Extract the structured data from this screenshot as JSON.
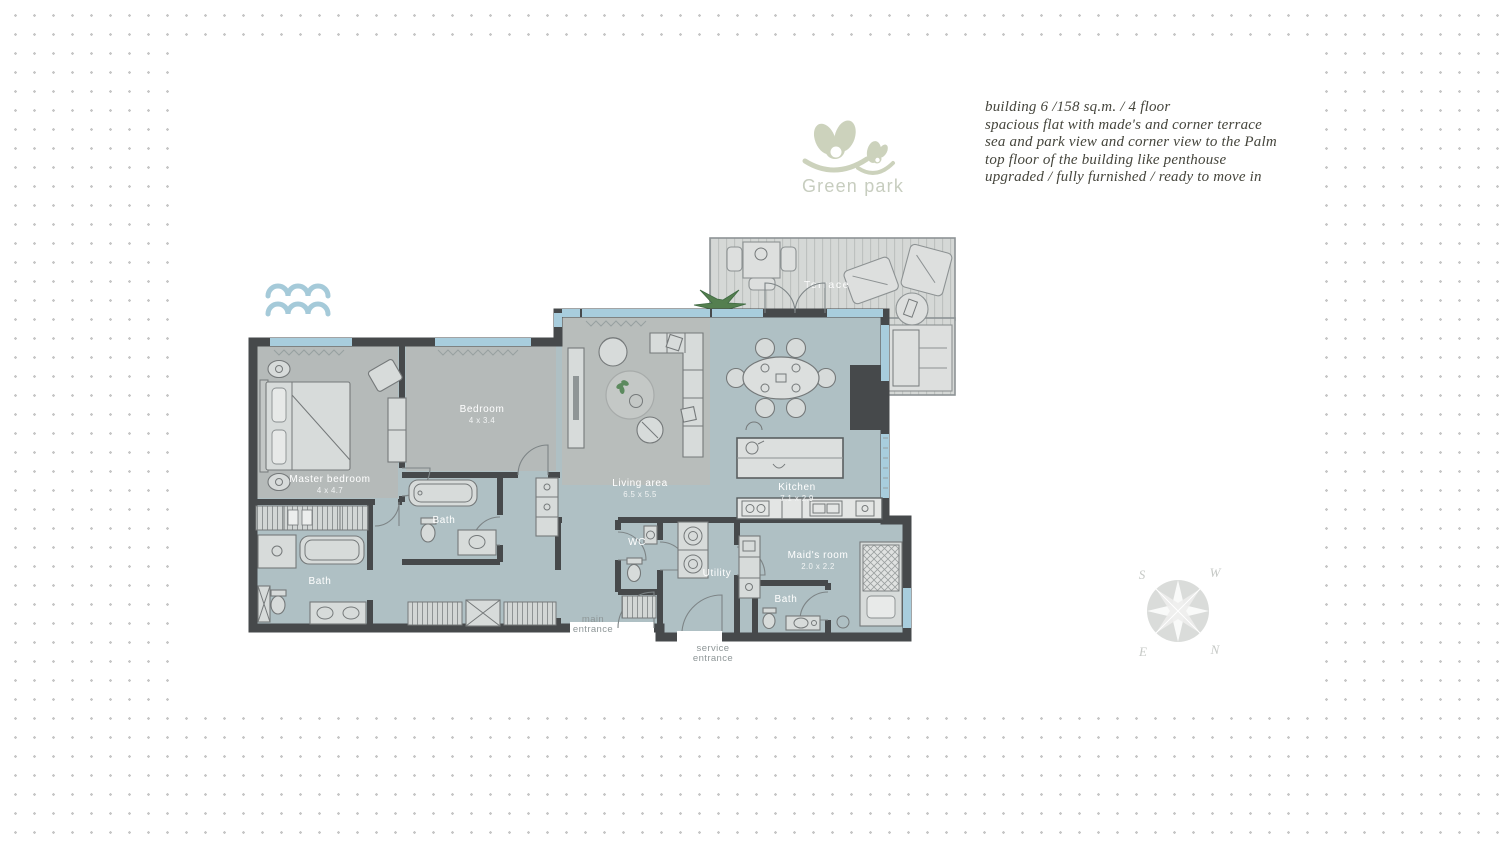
{
  "logo": {
    "name": "Green park"
  },
  "description": {
    "lines": [
      "building 6 /158 sq.m. / 4 floor",
      "spacious flat with made's and corner terrace",
      "sea and park view and corner view to the Palm",
      "top floor of the building like penthouse",
      "upgraded / fully furnished / ready to move in"
    ]
  },
  "rooms": {
    "terrace": {
      "name": "Terrace"
    },
    "master_bedroom": {
      "name": "Master bedroom",
      "dims": "4 x 4.7"
    },
    "bedroom": {
      "name": "Bedroom",
      "dims": "4 x 3.4"
    },
    "bath_master": {
      "name": "Bath"
    },
    "bath_bedroom": {
      "name": "Bath"
    },
    "living_area": {
      "name": "Living area",
      "dims": "6.5 x 5.5"
    },
    "kitchen": {
      "name": "Kitchen",
      "dims": "7.1 x 2.9"
    },
    "wc": {
      "name": "WC"
    },
    "utility": {
      "name": "Utility"
    },
    "maids_room": {
      "name": "Maid's room",
      "dims": "2.0 x 2.2"
    },
    "bath_maid": {
      "name": "Bath"
    }
  },
  "entrances": {
    "main": [
      "main",
      "entrance"
    ],
    "service": [
      "service",
      "entrance"
    ]
  },
  "compass": {
    "s": "S",
    "w": "W",
    "e": "E",
    "n": "N"
  },
  "icons": {
    "waves": "sea-waves",
    "compass": "compass-rose",
    "plant": "terrace-plant"
  },
  "colors": {
    "wall": "#46494b",
    "floor": "#afc0c4",
    "window": "#a8cddd",
    "terrace_floor": "#d5d8d6",
    "wave_blue": "#a5cad9",
    "logo_green": "#ccd2bc",
    "plant_green": "#547f4f"
  }
}
